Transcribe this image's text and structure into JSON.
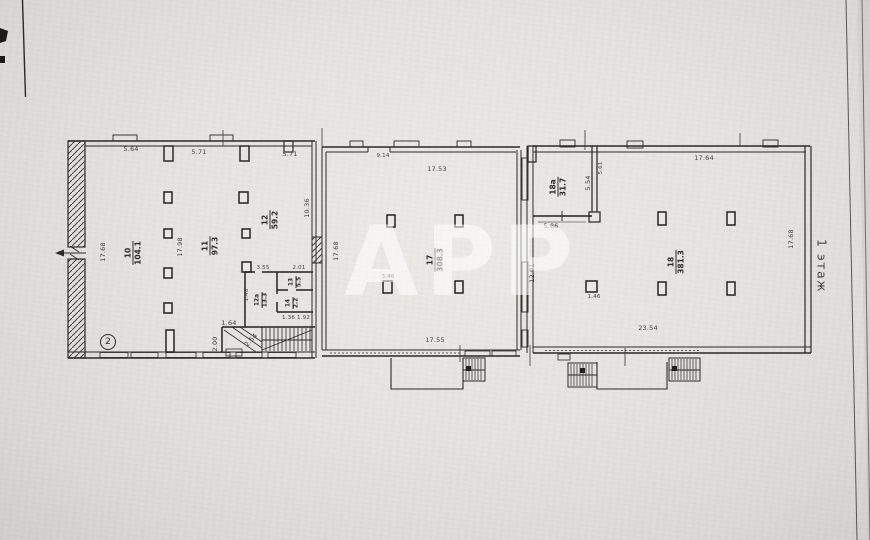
{
  "meta": {
    "floor_label": "1 этаж",
    "watermark_text": "АРР",
    "entrance_badge": "2"
  },
  "rooms": [
    {
      "number": "10",
      "area": "104.1"
    },
    {
      "number": "11",
      "area": "97.3"
    },
    {
      "number": "12",
      "area": "59.2"
    },
    {
      "number": "12а",
      "area": "13.3"
    },
    {
      "number": "13",
      "area": "5.5"
    },
    {
      "number": "14",
      "area": "2.2"
    },
    {
      "number": "17",
      "area": "308.3"
    },
    {
      "number": "18",
      "area": "381.3"
    },
    {
      "number": "18а",
      "area": "31.7"
    }
  ],
  "dims": {
    "left_top_a": "5.64",
    "left_top_b": "5.71",
    "left_top_c": "5.71",
    "left_wall_h": "17.68",
    "left_mid_h": "17.98",
    "divider1_h": "10.36",
    "mid_left_h": "17.68",
    "mid_top_small": "9.14",
    "mid_top": "17.53",
    "mid_bottom": "17.55",
    "mid_pillar": "3.46",
    "divider2_h": "12.01",
    "r18a_bottom": "5.86",
    "r18a_right_h": "5.54",
    "r18a_opening": "5.61",
    "right_top": "17.64",
    "right_wall_h": "17.68",
    "right_bottom": "23.54",
    "r18_pillar": "1.46",
    "stair_top": "1.64",
    "stair_left_h": "2.00",
    "stair_diag": "2.54",
    "block_top_a": "3.55",
    "block_top_b": "2.01",
    "block_left_h": "1.48",
    "block_bottom": "1.36  1.92"
  }
}
